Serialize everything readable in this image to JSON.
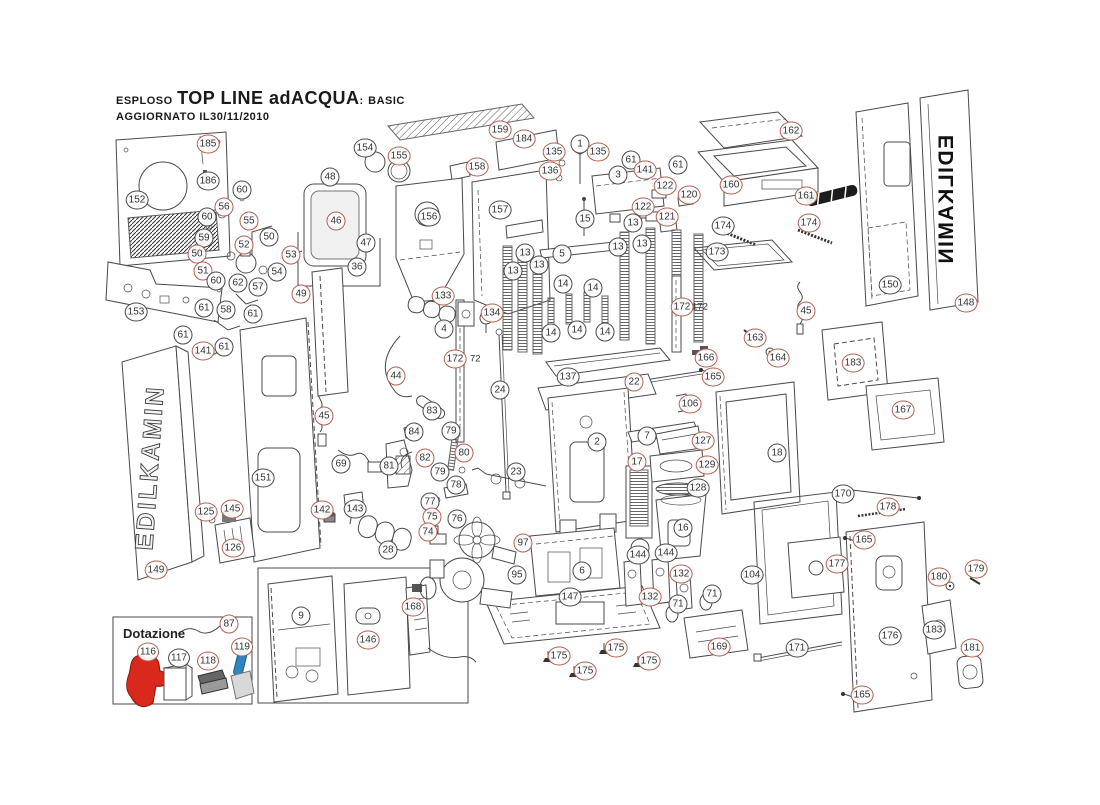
{
  "title": {
    "prefix": "ESPLOSO",
    "name": "TOP LINE  adACQUA",
    "sep": ":",
    "variant": "BASIC",
    "updated": "AGGIORNATO  IL30/11/2010"
  },
  "brand": {
    "left": "EDILKAMIN",
    "right": "EDILKAMIN"
  },
  "dotazione": {
    "label": "Dotazione"
  },
  "colors": {
    "callout_red": "#b4604f",
    "callout_black": "#4a4a4a",
    "glove": "#d9291c",
    "scraper_handle": "#2e86c1",
    "handle_bar": "#1c1c1c"
  },
  "tags": [
    {
      "t": "72",
      "x": 470,
      "y": 359
    },
    {
      "t": "172",
      "x": 692,
      "y": 307
    }
  ],
  "callouts": [
    {
      "n": "185",
      "x": 208,
      "y": 144,
      "c": "r"
    },
    {
      "n": "186",
      "x": 208,
      "y": 181,
      "c": "k"
    },
    {
      "n": "60",
      "x": 242,
      "y": 190,
      "c": "k"
    },
    {
      "n": "152",
      "x": 137,
      "y": 200,
      "c": "k"
    },
    {
      "n": "56",
      "x": 224,
      "y": 207,
      "c": "r"
    },
    {
      "n": "60",
      "x": 207,
      "y": 217,
      "c": "k"
    },
    {
      "n": "55",
      "x": 249,
      "y": 221,
      "c": "r"
    },
    {
      "n": "59",
      "x": 204,
      "y": 238,
      "c": "k"
    },
    {
      "n": "50",
      "x": 269,
      "y": 237,
      "c": "k"
    },
    {
      "n": "52",
      "x": 244,
      "y": 245,
      "c": "r"
    },
    {
      "n": "53",
      "x": 291,
      "y": 255,
      "c": "r"
    },
    {
      "n": "50",
      "x": 197,
      "y": 254,
      "c": "r"
    },
    {
      "n": "51",
      "x": 203,
      "y": 271,
      "c": "r"
    },
    {
      "n": "54",
      "x": 277,
      "y": 272,
      "c": "k"
    },
    {
      "n": "60",
      "x": 216,
      "y": 281,
      "c": "k"
    },
    {
      "n": "62",
      "x": 238,
      "y": 283,
      "c": "k"
    },
    {
      "n": "57",
      "x": 258,
      "y": 287,
      "c": "k"
    },
    {
      "n": "153",
      "x": 136,
      "y": 312,
      "c": "k"
    },
    {
      "n": "49",
      "x": 301,
      "y": 294,
      "c": "r"
    },
    {
      "n": "61",
      "x": 204,
      "y": 308,
      "c": "k"
    },
    {
      "n": "58",
      "x": 226,
      "y": 310,
      "c": "k"
    },
    {
      "n": "61",
      "x": 253,
      "y": 314,
      "c": "k"
    },
    {
      "n": "61",
      "x": 183,
      "y": 335,
      "c": "k"
    },
    {
      "n": "141",
      "x": 203,
      "y": 351,
      "c": "r"
    },
    {
      "n": "61",
      "x": 224,
      "y": 347,
      "c": "k"
    },
    {
      "n": "45",
      "x": 324,
      "y": 416,
      "c": "r"
    },
    {
      "n": "69",
      "x": 341,
      "y": 464,
      "c": "k"
    },
    {
      "n": "149",
      "x": 156,
      "y": 570,
      "c": "r"
    },
    {
      "n": "151",
      "x": 263,
      "y": 478,
      "c": "k"
    },
    {
      "n": "125",
      "x": 206,
      "y": 512,
      "c": "r"
    },
    {
      "n": "145",
      "x": 232,
      "y": 509,
      "c": "r"
    },
    {
      "n": "126",
      "x": 233,
      "y": 548,
      "c": "r"
    },
    {
      "n": "142",
      "x": 322,
      "y": 510,
      "c": "r"
    },
    {
      "n": "143",
      "x": 355,
      "y": 509,
      "c": "k"
    },
    {
      "n": "28",
      "x": 388,
      "y": 550,
      "c": "k"
    },
    {
      "n": "87",
      "x": 229,
      "y": 624,
      "c": "r"
    },
    {
      "n": "116",
      "x": 148,
      "y": 652,
      "c": "r"
    },
    {
      "n": "117",
      "x": 179,
      "y": 658,
      "c": "k"
    },
    {
      "n": "118",
      "x": 208,
      "y": 661,
      "c": "r"
    },
    {
      "n": "119",
      "x": 242,
      "y": 647,
      "c": "r"
    },
    {
      "n": "9",
      "x": 301,
      "y": 616,
      "c": "k"
    },
    {
      "n": "146",
      "x": 368,
      "y": 640,
      "c": "r"
    },
    {
      "n": "168",
      "x": 413,
      "y": 607,
      "c": "r"
    },
    {
      "n": "48",
      "x": 330,
      "y": 177,
      "c": "k"
    },
    {
      "n": "46",
      "x": 336,
      "y": 221,
      "c": "r"
    },
    {
      "n": "47",
      "x": 366,
      "y": 243,
      "c": "k"
    },
    {
      "n": "36",
      "x": 357,
      "y": 267,
      "c": "k"
    },
    {
      "n": "154",
      "x": 365,
      "y": 148,
      "c": "k"
    },
    {
      "n": "155",
      "x": 399,
      "y": 156,
      "c": "r"
    },
    {
      "n": "159",
      "x": 500,
      "y": 130,
      "c": "r"
    },
    {
      "n": "184",
      "x": 524,
      "y": 139,
      "c": "r"
    },
    {
      "n": "158",
      "x": 477,
      "y": 167,
      "c": "r"
    },
    {
      "n": "156",
      "x": 429,
      "y": 217,
      "c": "k"
    },
    {
      "n": "157",
      "x": 500,
      "y": 210,
      "c": "k"
    },
    {
      "n": "133",
      "x": 443,
      "y": 296,
      "c": "r"
    },
    {
      "n": "4",
      "x": 444,
      "y": 329,
      "c": "k"
    },
    {
      "n": "134",
      "x": 492,
      "y": 313,
      "c": "r"
    },
    {
      "n": "44",
      "x": 396,
      "y": 376,
      "c": "r"
    },
    {
      "n": "172",
      "x": 455,
      "y": 359,
      "c": "r"
    },
    {
      "n": "24",
      "x": 500,
      "y": 390,
      "c": "k"
    },
    {
      "n": "137",
      "x": 568,
      "y": 377,
      "c": "k"
    },
    {
      "n": "22",
      "x": 634,
      "y": 382,
      "c": "r"
    },
    {
      "n": "135",
      "x": 554,
      "y": 152,
      "c": "r"
    },
    {
      "n": "1",
      "x": 580,
      "y": 144,
      "c": "k"
    },
    {
      "n": "135",
      "x": 598,
      "y": 152,
      "c": "r"
    },
    {
      "n": "136",
      "x": 550,
      "y": 171,
      "c": "r"
    },
    {
      "n": "3",
      "x": 618,
      "y": 175,
      "c": "k"
    },
    {
      "n": "61",
      "x": 631,
      "y": 160,
      "c": "k"
    },
    {
      "n": "141",
      "x": 645,
      "y": 170,
      "c": "r"
    },
    {
      "n": "61",
      "x": 678,
      "y": 165,
      "c": "k"
    },
    {
      "n": "162",
      "x": 791,
      "y": 131,
      "c": "r"
    },
    {
      "n": "160",
      "x": 731,
      "y": 185,
      "c": "r"
    },
    {
      "n": "161",
      "x": 806,
      "y": 196,
      "c": "r"
    },
    {
      "n": "122",
      "x": 665,
      "y": 186,
      "c": "r"
    },
    {
      "n": "122",
      "x": 643,
      "y": 207,
      "c": "r"
    },
    {
      "n": "120",
      "x": 689,
      "y": 195,
      "c": "r"
    },
    {
      "n": "121",
      "x": 667,
      "y": 217,
      "c": "r"
    },
    {
      "n": "15",
      "x": 585,
      "y": 219,
      "c": "k"
    },
    {
      "n": "5",
      "x": 562,
      "y": 254,
      "c": "k"
    },
    {
      "n": "13",
      "x": 525,
      "y": 253,
      "c": "k"
    },
    {
      "n": "13",
      "x": 539,
      "y": 265,
      "c": "k"
    },
    {
      "n": "13",
      "x": 513,
      "y": 271,
      "c": "k"
    },
    {
      "n": "13",
      "x": 633,
      "y": 223,
      "c": "k"
    },
    {
      "n": "13",
      "x": 618,
      "y": 247,
      "c": "k"
    },
    {
      "n": "13",
      "x": 642,
      "y": 244,
      "c": "k"
    },
    {
      "n": "14",
      "x": 563,
      "y": 284,
      "c": "k"
    },
    {
      "n": "14",
      "x": 593,
      "y": 288,
      "c": "k"
    },
    {
      "n": "14",
      "x": 551,
      "y": 333,
      "c": "k"
    },
    {
      "n": "14",
      "x": 577,
      "y": 330,
      "c": "k"
    },
    {
      "n": "14",
      "x": 605,
      "y": 332,
      "c": "k"
    },
    {
      "n": "174",
      "x": 723,
      "y": 226,
      "c": "k"
    },
    {
      "n": "174",
      "x": 809,
      "y": 223,
      "c": "r"
    },
    {
      "n": "173",
      "x": 717,
      "y": 252,
      "c": "k"
    },
    {
      "n": "172",
      "x": 682,
      "y": 307,
      "c": "r"
    },
    {
      "n": "45",
      "x": 806,
      "y": 311,
      "c": "r"
    },
    {
      "n": "166",
      "x": 706,
      "y": 358,
      "c": "r"
    },
    {
      "n": "163",
      "x": 755,
      "y": 338,
      "c": "r"
    },
    {
      "n": "164",
      "x": 778,
      "y": 358,
      "c": "r"
    },
    {
      "n": "165",
      "x": 713,
      "y": 377,
      "c": "r"
    },
    {
      "n": "106",
      "x": 690,
      "y": 404,
      "c": "r"
    },
    {
      "n": "127",
      "x": 703,
      "y": 441,
      "c": "r"
    },
    {
      "n": "129",
      "x": 707,
      "y": 465,
      "c": "r"
    },
    {
      "n": "128",
      "x": 698,
      "y": 488,
      "c": "k"
    },
    {
      "n": "16",
      "x": 683,
      "y": 528,
      "c": "k"
    },
    {
      "n": "18",
      "x": 777,
      "y": 453,
      "c": "k"
    },
    {
      "n": "183",
      "x": 853,
      "y": 363,
      "c": "r"
    },
    {
      "n": "167",
      "x": 903,
      "y": 410,
      "c": "r"
    },
    {
      "n": "2",
      "x": 597,
      "y": 442,
      "c": "k"
    },
    {
      "n": "7",
      "x": 647,
      "y": 436,
      "c": "k"
    },
    {
      "n": "17",
      "x": 637,
      "y": 462,
      "c": "r"
    },
    {
      "n": "23",
      "x": 516,
      "y": 472,
      "c": "k"
    },
    {
      "n": "83",
      "x": 432,
      "y": 411,
      "c": "k"
    },
    {
      "n": "84",
      "x": 414,
      "y": 432,
      "c": "k"
    },
    {
      "n": "79",
      "x": 451,
      "y": 431,
      "c": "k"
    },
    {
      "n": "82",
      "x": 425,
      "y": 458,
      "c": "r"
    },
    {
      "n": "80",
      "x": 464,
      "y": 453,
      "c": "r"
    },
    {
      "n": "81",
      "x": 389,
      "y": 466,
      "c": "k"
    },
    {
      "n": "79",
      "x": 440,
      "y": 472,
      "c": "k"
    },
    {
      "n": "78",
      "x": 456,
      "y": 485,
      "c": "k"
    },
    {
      "n": "77",
      "x": 430,
      "y": 502,
      "c": "k"
    },
    {
      "n": "75",
      "x": 432,
      "y": 517,
      "c": "r"
    },
    {
      "n": "76",
      "x": 457,
      "y": 519,
      "c": "k"
    },
    {
      "n": "74",
      "x": 428,
      "y": 532,
      "c": "r"
    },
    {
      "n": "97",
      "x": 523,
      "y": 543,
      "c": "r"
    },
    {
      "n": "95",
      "x": 517,
      "y": 575,
      "c": "k"
    },
    {
      "n": "6",
      "x": 582,
      "y": 571,
      "c": "k"
    },
    {
      "n": "144",
      "x": 638,
      "y": 555,
      "c": "k"
    },
    {
      "n": "144",
      "x": 666,
      "y": 553,
      "c": "k"
    },
    {
      "n": "132",
      "x": 681,
      "y": 574,
      "c": "r"
    },
    {
      "n": "132",
      "x": 650,
      "y": 597,
      "c": "r"
    },
    {
      "n": "71",
      "x": 678,
      "y": 604,
      "c": "k"
    },
    {
      "n": "71",
      "x": 712,
      "y": 594,
      "c": "k"
    },
    {
      "n": "147",
      "x": 570,
      "y": 597,
      "c": "k"
    },
    {
      "n": "104",
      "x": 752,
      "y": 575,
      "c": "k"
    },
    {
      "n": "170",
      "x": 843,
      "y": 494,
      "c": "k"
    },
    {
      "n": "178",
      "x": 888,
      "y": 507,
      "c": "r"
    },
    {
      "n": "165",
      "x": 864,
      "y": 540,
      "c": "r"
    },
    {
      "n": "177",
      "x": 837,
      "y": 564,
      "c": "r"
    },
    {
      "n": "180",
      "x": 939,
      "y": 577,
      "c": "r"
    },
    {
      "n": "179",
      "x": 976,
      "y": 569,
      "c": "r"
    },
    {
      "n": "176",
      "x": 890,
      "y": 636,
      "c": "k"
    },
    {
      "n": "183",
      "x": 934,
      "y": 630,
      "c": "k"
    },
    {
      "n": "181",
      "x": 972,
      "y": 648,
      "c": "r"
    },
    {
      "n": "171",
      "x": 797,
      "y": 648,
      "c": "k"
    },
    {
      "n": "165",
      "x": 862,
      "y": 695,
      "c": "r"
    },
    {
      "n": "169",
      "x": 719,
      "y": 647,
      "c": "r"
    },
    {
      "n": "175",
      "x": 559,
      "y": 656,
      "c": "r"
    },
    {
      "n": "175",
      "x": 616,
      "y": 648,
      "c": "r"
    },
    {
      "n": "175",
      "x": 585,
      "y": 671,
      "c": "r"
    },
    {
      "n": "175",
      "x": 649,
      "y": 661,
      "c": "r"
    },
    {
      "n": "150",
      "x": 890,
      "y": 285,
      "c": "k"
    },
    {
      "n": "148",
      "x": 966,
      "y": 303,
      "c": "r"
    }
  ]
}
